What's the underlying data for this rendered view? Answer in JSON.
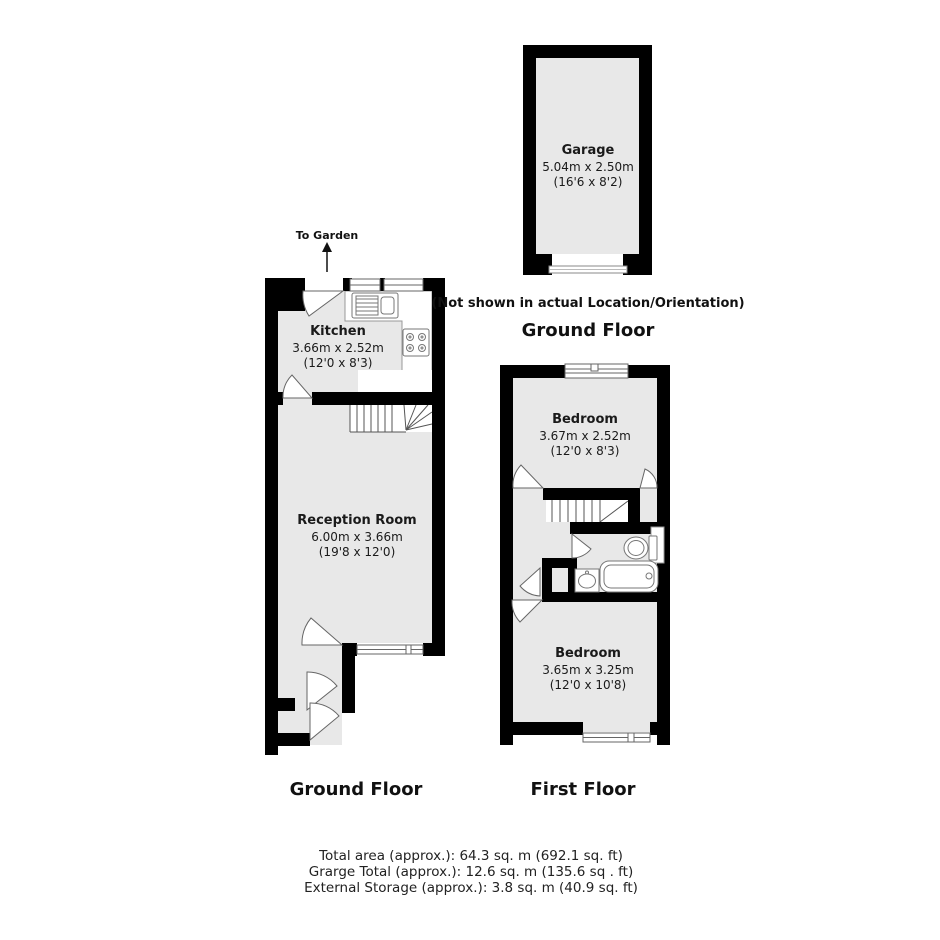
{
  "colors": {
    "wall": "#000000",
    "room_fill": "#e8e8e8",
    "background": "#ffffff",
    "fixture_line": "#777777",
    "text": "#1a1a1a"
  },
  "garage_plan": {
    "room": {
      "name": "Garage",
      "metric": "5.04m x 2.50m",
      "imperial": "(16'6 x 8'2)"
    },
    "note": "(Not shown in actual Location/Orientation)",
    "floor_label": "Ground Floor"
  },
  "ground_floor_plan": {
    "floor_label": "Ground Floor",
    "to_garden": "To Garden",
    "kitchen": {
      "name": "Kitchen",
      "metric": "3.66m x 2.52m",
      "imperial": "(12'0 x 8'3)"
    },
    "reception": {
      "name": "Reception Room",
      "metric": "6.00m x 3.66m",
      "imperial": "(19'8 x 12'0)"
    }
  },
  "first_floor_plan": {
    "floor_label": "First Floor",
    "bedroom_front": {
      "name": "Bedroom",
      "metric": "3.67m x 2.52m",
      "imperial": "(12'0 x 8'3)"
    },
    "bedroom_back": {
      "name": "Bedroom",
      "metric": "3.65m x 3.25m",
      "imperial": "(12'0 x 10'8)"
    }
  },
  "footer": {
    "line1": "Total area (approx.): 64.3 sq. m (692.1 sq. ft)",
    "line2": "Grarge Total (approx.): 12.6 sq. m (135.6 sq . ft)",
    "line3": "External Storage (approx.): 3.8 sq. m (40.9 sq. ft)"
  }
}
